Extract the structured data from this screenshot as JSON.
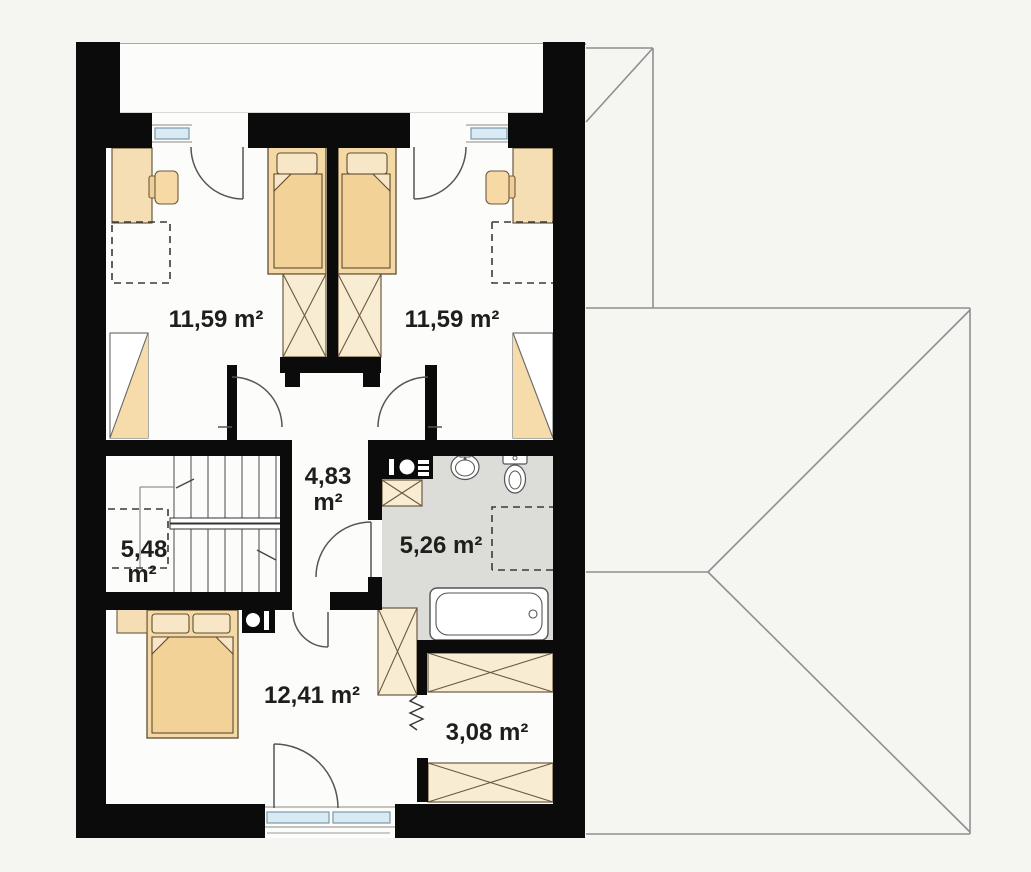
{
  "plan": {
    "type": "attic-floor-plan",
    "rooms": [
      {
        "id": "bedroom-top-left",
        "area": "11,59 m²"
      },
      {
        "id": "bedroom-top-right",
        "area": "11,59 m²"
      },
      {
        "id": "hall",
        "area_value": "4,83",
        "area_unit": "m²"
      },
      {
        "id": "staircase",
        "area_value": "5,48",
        "area_unit": "m²"
      },
      {
        "id": "bathroom",
        "area": "5,26 m²"
      },
      {
        "id": "bedroom-bottom",
        "area": "12,41 m²"
      },
      {
        "id": "wardrobe",
        "area": "3,08 m²"
      }
    ],
    "fixtures": [
      "single-bed",
      "single-bed",
      "double-bed",
      "desk",
      "chair",
      "wardrobe-crossed",
      "sloped-ceiling-closet",
      "staircase",
      "railing",
      "bathtub",
      "toilet",
      "washbasin",
      "washer-dryer",
      "vent-flue",
      "window",
      "door-swing",
      "roof-outline",
      "balcony-strip",
      "zigzag-opening"
    ],
    "colors": {
      "background": "#f5f5f2",
      "floor": "#fcfcfb",
      "bathroom_floor": "#dcdcd9",
      "wall": "#0b0b0b",
      "furniture_beige": "#f5d9a5",
      "furniture_cream": "#f8ecd3",
      "window_glass": "#d8eaf4",
      "thin_line": "#555555",
      "roof_line": "#8f8f8f",
      "label_text": "#1e1e1c"
    }
  }
}
